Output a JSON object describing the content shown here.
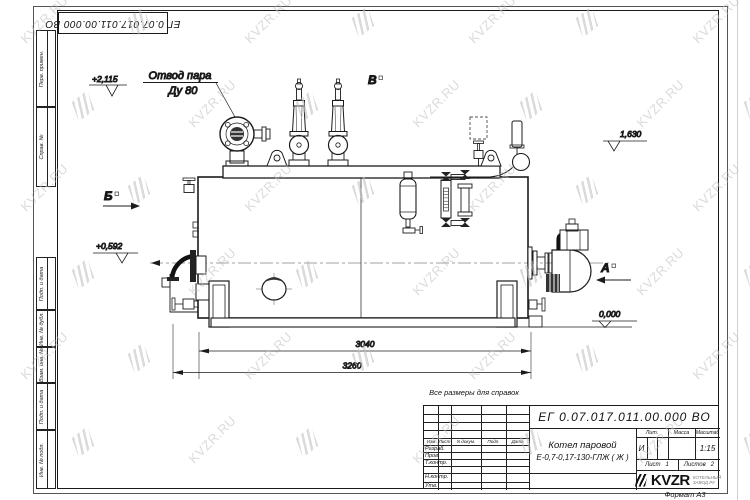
{
  "watermark": {
    "text": "KVZR.RU"
  },
  "frame": {
    "doc_number_top": "ЕГ 0.07.017.011.00.000  ВО",
    "stamps": [
      "Перв. примен.",
      "Справ. №",
      "Подп. и дата",
      "Инв. № дубл.",
      "Взам. инв. №",
      "Подп. и дата",
      "Инв. № подл."
    ]
  },
  "drawing": {
    "callout": {
      "line1": "Отвод пара",
      "line2": "Ду 80"
    },
    "elevations": [
      {
        "value": "+2,115"
      },
      {
        "value": "1,630"
      },
      {
        "value": "+0,592"
      },
      {
        "value": "0,000"
      }
    ],
    "markers": [
      {
        "label": "Б"
      },
      {
        "label": "В"
      },
      {
        "label": "А"
      }
    ],
    "dims": [
      {
        "value": "3040"
      },
      {
        "value": "3260"
      }
    ]
  },
  "title_block": {
    "reference_note": "Все размеры для справок",
    "doc_number": "ЕГ 0.07.017.011.00.000  ВО",
    "product_name_line1": "Котел паровой",
    "product_name_line2": "Е-0,7-0,17-130-ГЛЖ ( Ж )",
    "headers": [
      "Изм",
      "Лист",
      "N докум.",
      "Подп.",
      "Дата"
    ],
    "rows": [
      "Разраб.",
      "Пров.",
      "Т.контр.",
      "Н.контр.",
      "Утв."
    ],
    "lit_header": "Лит.",
    "mass_header": "Масса",
    "scale_header": "Масштаб",
    "lit_value": "И",
    "scale_value": "1:15",
    "sheet_label": "Лист",
    "sheet_value": "1",
    "sheets_label": "Листов",
    "sheets_value": "2",
    "format_note": "Формат А3",
    "logo_word": "KVZR",
    "logo_sub1": "КОТЕЛЬНЫЙ",
    "logo_sub2": "ЗАВОД.РУ"
  }
}
